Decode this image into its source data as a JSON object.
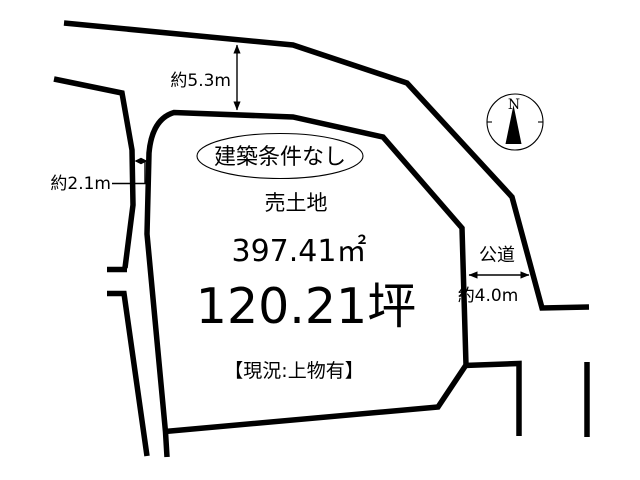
{
  "diagram": {
    "plot": {
      "badge_label": "建築条件なし",
      "listing_type": "売土地",
      "area_sqm": "397.41㎡",
      "area_tsubo": "120.21坪",
      "current_status": "【現況:上物有】"
    },
    "dimensions": {
      "top_road_width": "約5.3m",
      "left_road_width": "約2.1m",
      "right_road_width": "約4.0m"
    },
    "roads": {
      "right_road_label": "公道"
    },
    "compass": {
      "north_label": "N"
    },
    "colors": {
      "line": "#000000",
      "background": "#ffffff"
    }
  }
}
